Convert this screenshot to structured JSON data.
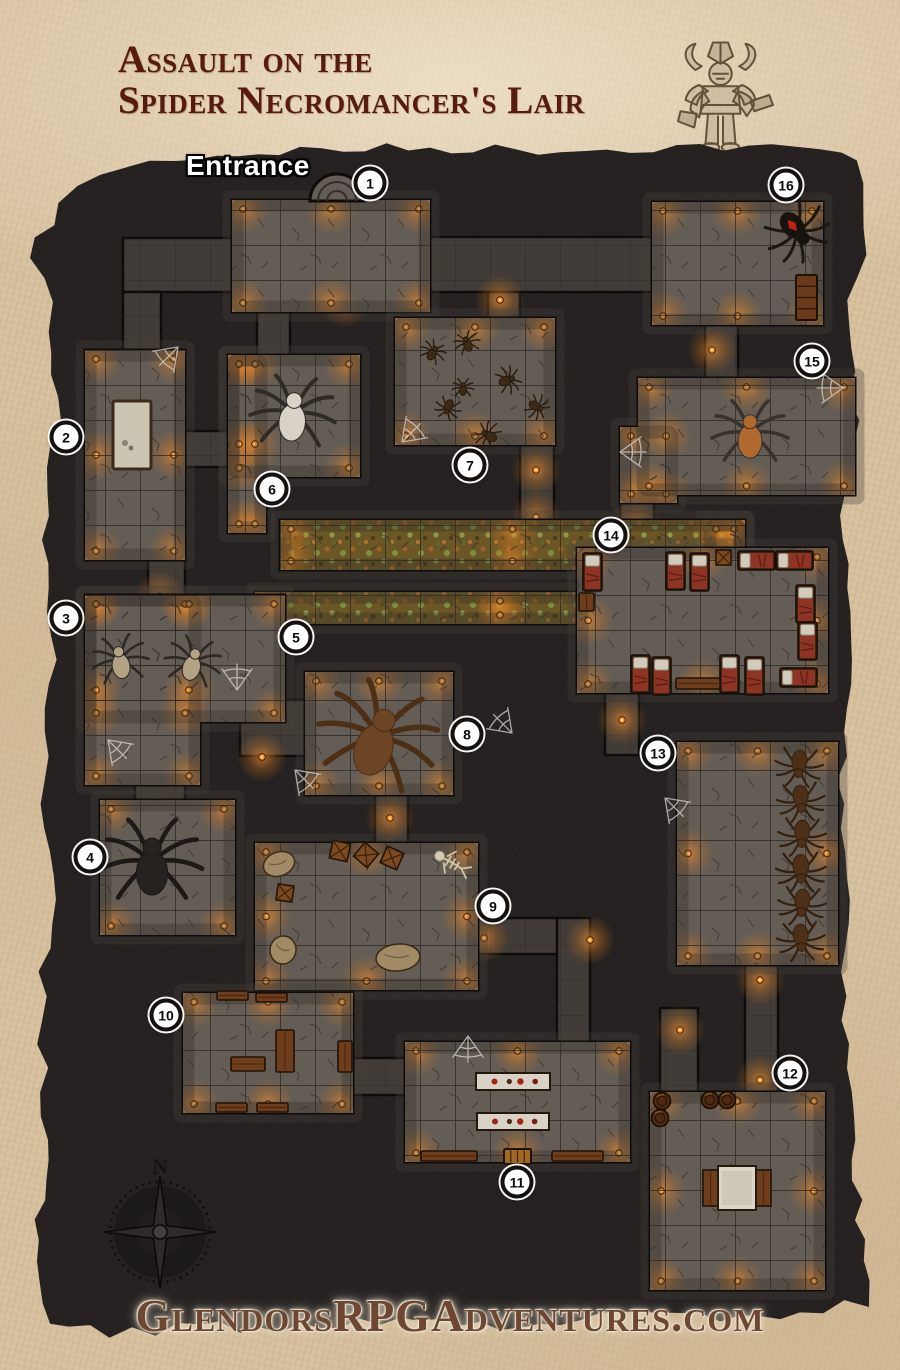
{
  "page": {
    "width": 900,
    "height": 1370
  },
  "header": {
    "title_line1": "Assault on the",
    "title_line2": "Spider Necromancer's Lair",
    "title_color": "#571b0f"
  },
  "map": {
    "entrance_label": "Entrance",
    "compass_label": "N",
    "markers": [
      {
        "n": "1",
        "x": 370,
        "y": 183
      },
      {
        "n": "2",
        "x": 66,
        "y": 437
      },
      {
        "n": "3",
        "x": 66,
        "y": 618
      },
      {
        "n": "4",
        "x": 90,
        "y": 857
      },
      {
        "n": "5",
        "x": 296,
        "y": 637
      },
      {
        "n": "6",
        "x": 272,
        "y": 489
      },
      {
        "n": "7",
        "x": 470,
        "y": 465
      },
      {
        "n": "8",
        "x": 467,
        "y": 734
      },
      {
        "n": "9",
        "x": 493,
        "y": 906
      },
      {
        "n": "10",
        "x": 166,
        "y": 1015
      },
      {
        "n": "11",
        "x": 517,
        "y": 1182
      },
      {
        "n": "12",
        "x": 790,
        "y": 1073
      },
      {
        "n": "13",
        "x": 658,
        "y": 753
      },
      {
        "n": "14",
        "x": 611,
        "y": 535
      },
      {
        "n": "15",
        "x": 812,
        "y": 361
      },
      {
        "n": "16",
        "x": 786,
        "y": 185
      }
    ],
    "features": {
      "spiders": [
        {
          "kind": "giant-white",
          "x": 293,
          "y": 413,
          "size": 78,
          "body": "#d9d2c6",
          "legs": "#2e2a26",
          "rot": 5
        },
        {
          "kind": "black-widow",
          "x": 797,
          "y": 231,
          "size": 60,
          "body": "#16120e",
          "legs": "#1b1713",
          "accent": "#c22414",
          "rot": 140
        },
        {
          "kind": "orange",
          "x": 750,
          "y": 433,
          "size": 70,
          "body": "#b06a30",
          "legs": "#38322e",
          "rot": 0
        },
        {
          "kind": "black",
          "x": 152,
          "y": 862,
          "size": 92,
          "body": "#26221f",
          "legs": "#1c1916",
          "rot": 0
        },
        {
          "kind": "dead-brown",
          "x": 378,
          "y": 737,
          "size": 110,
          "body": "#6b4524",
          "legs": "#4d2f16",
          "rot": 20
        },
        {
          "kind": "tan",
          "x": 120,
          "y": 660,
          "size": 52,
          "body": "#b3a284",
          "legs": "#2c2824",
          "rot": -10
        },
        {
          "kind": "tan",
          "x": 193,
          "y": 662,
          "size": 52,
          "body": "#b3a284",
          "legs": "#2c2824",
          "rot": 15
        },
        {
          "kind": "small",
          "x": 433,
          "y": 352,
          "size": 24,
          "body": "#3c2a16",
          "legs": "#281a0c",
          "rot": 30
        },
        {
          "kind": "small",
          "x": 467,
          "y": 343,
          "size": 24,
          "body": "#3c2a16",
          "legs": "#281a0c",
          "rot": -20
        },
        {
          "kind": "small",
          "x": 508,
          "y": 380,
          "size": 26,
          "body": "#3c2a16",
          "legs": "#281a0c",
          "rot": 70
        },
        {
          "kind": "small",
          "x": 448,
          "y": 408,
          "size": 24,
          "body": "#3c2a16",
          "legs": "#281a0c",
          "rot": 200
        },
        {
          "kind": "small",
          "x": 537,
          "y": 407,
          "size": 24,
          "body": "#3c2a16",
          "legs": "#281a0c",
          "rot": 120
        },
        {
          "kind": "small",
          "x": 488,
          "y": 435,
          "size": 26,
          "body": "#3c2a16",
          "legs": "#281a0c",
          "rot": -60
        },
        {
          "kind": "small",
          "x": 463,
          "y": 388,
          "size": 20,
          "body": "#3c2a16",
          "legs": "#281a0c",
          "rot": 0
        },
        {
          "kind": "brown",
          "x": 799,
          "y": 766,
          "size": 44,
          "body": "#4e3018",
          "legs": "#33200e",
          "rot": 185
        },
        {
          "kind": "brown",
          "x": 801,
          "y": 801,
          "size": 44,
          "body": "#4e3018",
          "legs": "#33200e",
          "rot": 175
        },
        {
          "kind": "brown",
          "x": 802,
          "y": 836,
          "size": 44,
          "body": "#4e3018",
          "legs": "#33200e",
          "rot": 182
        },
        {
          "kind": "brown",
          "x": 801,
          "y": 871,
          "size": 46,
          "body": "#4e3018",
          "legs": "#33200e",
          "rot": 178
        },
        {
          "kind": "brown",
          "x": 802,
          "y": 905,
          "size": 44,
          "body": "#4e3018",
          "legs": "#33200e",
          "rot": 184
        },
        {
          "kind": "brown",
          "x": 801,
          "y": 940,
          "size": 44,
          "body": "#4e3018",
          "legs": "#33200e",
          "rot": 176
        }
      ],
      "pool": [
        113,
        401,
        38,
        68
      ],
      "beds": {
        "vertical": [
          [
            583,
            553
          ],
          [
            666,
            552
          ],
          [
            690,
            553
          ],
          [
            796,
            585
          ],
          [
            798,
            622
          ],
          [
            631,
            655
          ],
          [
            652,
            657
          ],
          [
            720,
            655
          ],
          [
            745,
            657
          ]
        ],
        "horizontal": [
          [
            738,
            551
          ],
          [
            776,
            551
          ],
          [
            780,
            668
          ]
        ]
      },
      "tables_room10": [
        [
          217,
          991,
          31,
          9
        ],
        [
          256,
          993,
          31,
          9
        ],
        [
          276,
          1030,
          18,
          42
        ],
        [
          231,
          1057,
          34,
          14
        ],
        [
          338,
          1041,
          14,
          31
        ],
        [
          216,
          1103,
          31,
          9
        ],
        [
          257,
          1103,
          31,
          9
        ]
      ],
      "white_tables": [
        [
          476,
          1073,
          74,
          17
        ],
        [
          477,
          1113,
          72,
          17
        ]
      ],
      "benches": [
        [
          421,
          1151,
          56,
          10
        ],
        [
          552,
          1151,
          51,
          10
        ],
        [
          676,
          678,
          44,
          11
        ]
      ],
      "doors": [
        [
          504,
          1149,
          27,
          15
        ],
        [
          796,
          275,
          21,
          45
        ]
      ],
      "crates": [
        [
          331,
          842,
          18,
          12
        ],
        [
          357,
          846,
          18,
          40
        ],
        [
          383,
          849,
          18,
          24
        ],
        [
          277,
          885,
          16,
          8
        ],
        [
          716,
          550,
          15,
          0
        ]
      ],
      "barrels": [
        [
          662,
          1101
        ],
        [
          660,
          1118
        ],
        [
          710,
          1100
        ],
        [
          727,
          1100
        ]
      ],
      "sacks": [
        [
          263,
          852,
          32,
          24,
          -20
        ],
        [
          270,
          936,
          26,
          28,
          10
        ],
        [
          376,
          944,
          44,
          27,
          -5
        ]
      ],
      "skeleton": [
        450,
        862,
        -60
      ],
      "altar": {
        "top": [
          718,
          1166,
          38,
          44
        ],
        "panels": [
          [
            703,
            1170,
            15,
            36
          ],
          [
            756,
            1170,
            15,
            36
          ]
        ]
      },
      "small_table": [
        579,
        593,
        15,
        18
      ]
    },
    "colors": {
      "parchment": "#d8c2a0",
      "map_bg": "#242120",
      "floor": "#645d55",
      "corridor": "#413c37",
      "torch": "#ff9a33",
      "moss": "#6b5626",
      "marker_bg": "#ffffff",
      "marker_ring": "#14110e",
      "outline": "#0d0c0b",
      "website_text": "#6e4733"
    }
  },
  "footer": {
    "website": "GlendorsRPGAdventures.com"
  }
}
